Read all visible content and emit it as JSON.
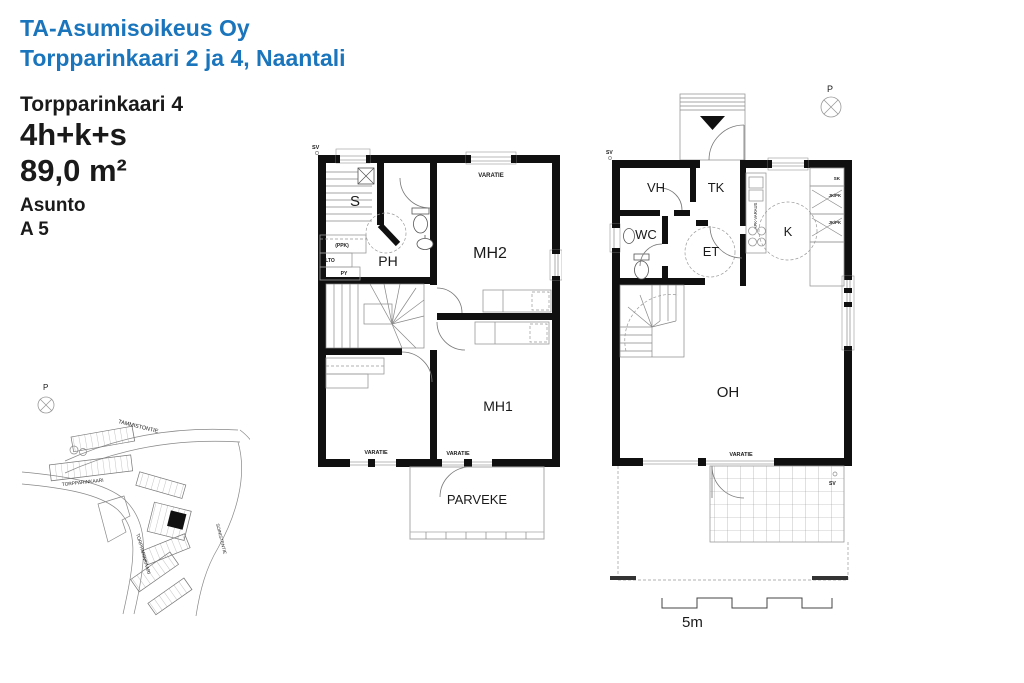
{
  "colors": {
    "accent_blue": "#1a75bc",
    "wall_black": "#101010"
  },
  "header": {
    "company": "TA-Asumisoikeus Oy",
    "address": "Torpparinkaari 2 ja 4, Naantali"
  },
  "apartment": {
    "street": "Torpparinkaari 4",
    "type": "4h+k+s",
    "area": "89,0 m²",
    "label": "Asunto",
    "code": "A 5"
  },
  "upper_plan": {
    "sv": "SV",
    "varatie_top": "VARATIE",
    "rooms": {
      "sauna": "S",
      "ph": "PH",
      "mh2": "MH2",
      "mh1": "MH1"
    },
    "small_labels": {
      "ppk": "(PPK)",
      "lto": "LTO",
      "py": "PY"
    },
    "varatie_bottom_left": "VARATIE",
    "varatie_bottom_right": "VARATIE",
    "balcony": "PARVEKE"
  },
  "ground_plan": {
    "sv_top": "SV",
    "sv_terrace": "SV",
    "compass": "P",
    "rooms": {
      "vh": "VH",
      "tk": "TK",
      "wc": "WC",
      "et": "ET",
      "k": "K",
      "oh": "OH"
    },
    "cabinets": {
      "sk": "SK",
      "jk_pk_1": "JK/PK",
      "jk_pk_2": "JK/PK",
      "apk": "APK-VARAUS"
    },
    "varatie": "VARATIE"
  },
  "site_map": {
    "compass": "P",
    "street_1": "TAMMISTONTIE",
    "street_2": "TORPPARINKAARI",
    "street_3": "TORPPARINKAARI",
    "street_4": "SOINISTENTIE"
  },
  "scale_bar": {
    "label": "5m"
  }
}
